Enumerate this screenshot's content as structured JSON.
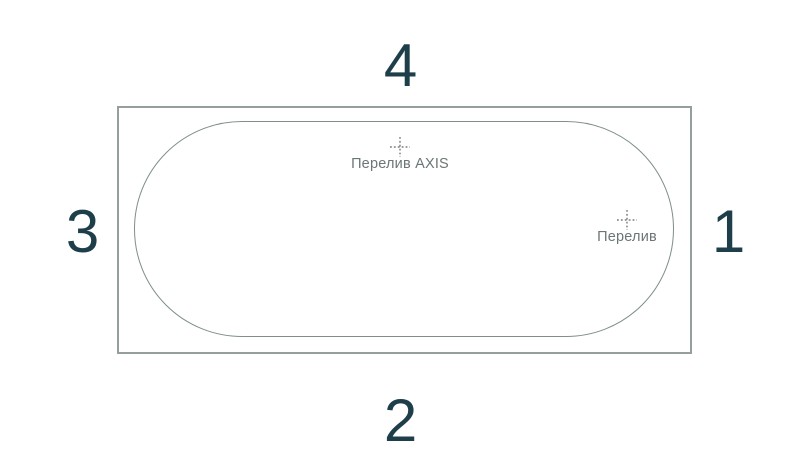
{
  "diagram": {
    "name": "bathtub-top-view-overflow-positions",
    "sides": {
      "top": "4",
      "bottom": "2",
      "left": "3",
      "right": "1"
    },
    "markers": {
      "axis": {
        "label": "Перелив AXIS"
      },
      "overflow": {
        "label": "Перелив"
      }
    },
    "colors": {
      "background": "#ffffff",
      "outer_outline": "#95a09d",
      "inner_outline": "#7f8e8a",
      "side_number": "#1e3f4a",
      "marker_cross": "#5c6668",
      "caption_text": "#6b7677"
    }
  }
}
